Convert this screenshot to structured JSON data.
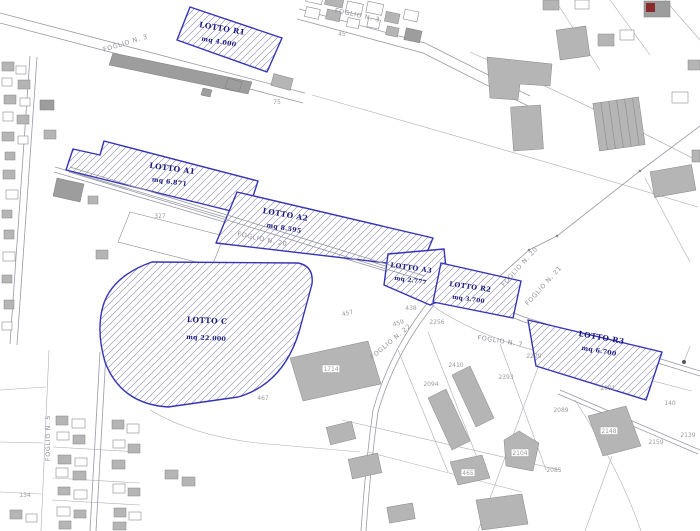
{
  "map": {
    "lots": [
      {
        "name": "LOTTO R1",
        "area": "mq 4.000"
      },
      {
        "name": "LOTTO A1",
        "area": "mq 6.871"
      },
      {
        "name": "LOTTO A2",
        "area": "mq 8.595"
      },
      {
        "name": "LOTTO A3",
        "area": "mq 2.777"
      },
      {
        "name": "LOTTO R2",
        "area": "mq 3.700"
      },
      {
        "name": "LOTTO C",
        "area": "mq 22.000"
      },
      {
        "name": "LOTTO R3",
        "area": "mq 6.700"
      }
    ],
    "foglio_labels": [
      {
        "text": "FOGLIO N. 3",
        "x": 126,
        "y": 45,
        "rot": -17
      },
      {
        "text": "FOGLIO N. 3",
        "x": 357,
        "y": 17,
        "rot": 12
      },
      {
        "text": "FOGLIO N. 20",
        "x": 262,
        "y": 241,
        "rot": 12
      },
      {
        "text": "FOGLIO N. 20",
        "x": 521,
        "y": 268,
        "rot": -48
      },
      {
        "text": "FOGLIO N. 21",
        "x": 545,
        "y": 287,
        "rot": -48
      },
      {
        "text": "FOGLIO N. 22",
        "x": 392,
        "y": 343,
        "rot": -40
      },
      {
        "text": "FOGLIO N. 7",
        "x": 500,
        "y": 343,
        "rot": 9
      },
      {
        "text": "FOGLIO N. 5",
        "x": 50,
        "y": 438,
        "rot": -90
      }
    ],
    "parcel_numbers": [
      {
        "text": "75",
        "x": 277,
        "y": 104
      },
      {
        "text": "45",
        "x": 342,
        "y": 36
      },
      {
        "text": "327",
        "x": 160,
        "y": 218
      },
      {
        "text": "457",
        "x": 348,
        "y": 315,
        "rot": -14
      },
      {
        "text": "438",
        "x": 411,
        "y": 310
      },
      {
        "text": "459",
        "x": 399,
        "y": 325,
        "rot": -18
      },
      {
        "text": "2256",
        "x": 437,
        "y": 324
      },
      {
        "text": "2410",
        "x": 456,
        "y": 367
      },
      {
        "text": "2094",
        "x": 431,
        "y": 386
      },
      {
        "text": "2393",
        "x": 506,
        "y": 379
      },
      {
        "text": "2229",
        "x": 534,
        "y": 358
      },
      {
        "text": "467",
        "x": 263,
        "y": 400
      },
      {
        "text": "2089",
        "x": 561,
        "y": 412
      },
      {
        "text": "2091",
        "x": 608,
        "y": 390
      },
      {
        "text": "140",
        "x": 670,
        "y": 405
      },
      {
        "text": "2159",
        "x": 656,
        "y": 444
      },
      {
        "text": "2139",
        "x": 688,
        "y": 437
      },
      {
        "text": "2085",
        "x": 554,
        "y": 472
      },
      {
        "text": "134",
        "x": 25,
        "y": 497
      },
      {
        "text": "1714",
        "x": 331,
        "y": 371,
        "boxed": true
      },
      {
        "text": "2148",
        "x": 609,
        "y": 433,
        "boxed": true
      },
      {
        "text": "2104",
        "x": 520,
        "y": 455,
        "boxed": true
      },
      {
        "text": "465",
        "x": 468,
        "y": 475,
        "boxed": true
      }
    ],
    "colors": {
      "lot_outline": "#3434b8",
      "lot_label": "#181880",
      "building_fill": "#b5b5b5",
      "parcel_line": "#abacb4",
      "number_text": "#9a9a9a",
      "red_building": "#8b2a2a"
    }
  }
}
